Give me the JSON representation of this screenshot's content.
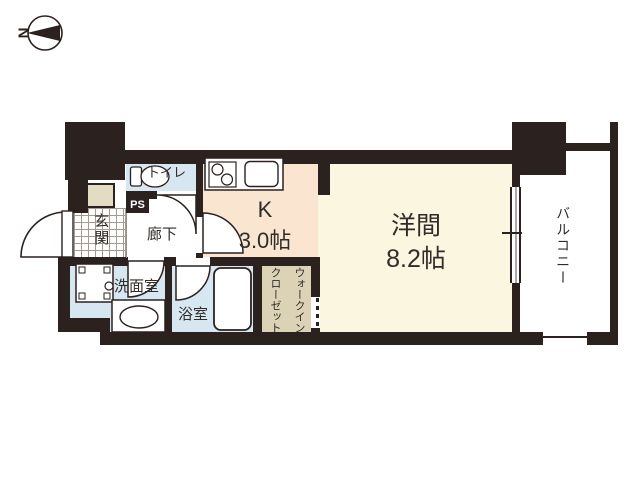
{
  "compass": {
    "north_label": "N"
  },
  "rooms": {
    "toilet": {
      "label": "トイレ"
    },
    "pipe_space": {
      "label": "PS"
    },
    "entrance": {
      "label": "玄関"
    },
    "corridor": {
      "label": "廊下"
    },
    "kitchen": {
      "label": "K",
      "size": "3.0帖"
    },
    "western_room": {
      "label": "洋間",
      "size": "8.2帖"
    },
    "walk_in_closet": {
      "line1": "ウォークイン",
      "line2": "クローゼット"
    },
    "washroom": {
      "label": "洗面室"
    },
    "bathroom": {
      "label": "浴室"
    },
    "balcony": {
      "label": "バルコニー"
    }
  },
  "colors": {
    "wall": "#2b211e",
    "wet_room_blue": "#d7e7f2",
    "kitchen_peach": "#fae5d0",
    "western_room_cream": "#faf6df",
    "closet_tan": "#dcd2b5",
    "cabinet_beige": "#e4dcc2"
  }
}
